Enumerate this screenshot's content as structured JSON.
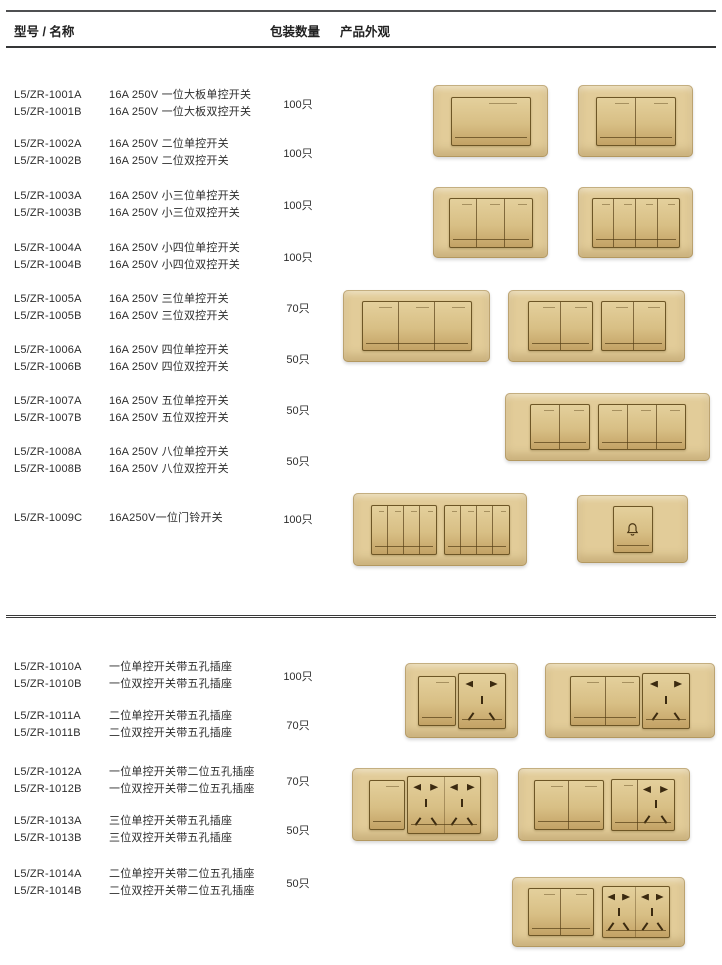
{
  "header": {
    "model_name": "型号 / 名称",
    "package_qty": "包装数量",
    "appearance": "产品外观"
  },
  "sections": [
    {
      "rows": [
        {
          "code_a": "L5/ZR-1001A",
          "desc_a": "16A 250V 一位大板单控开关",
          "code_b": "L5/ZR-1001B",
          "desc_b": "16A 250V 一位大板双控开关",
          "qty": "100只"
        },
        {
          "code_a": "L5/ZR-1002A",
          "desc_a": "16A 250V 二位单控开关",
          "code_b": "L5/ZR-1002B",
          "desc_b": "16A 250V 二位双控开关",
          "qty": "100只"
        },
        {
          "code_a": "L5/ZR-1003A",
          "desc_a": "16A 250V 小三位单控开关",
          "code_b": "L5/ZR-1003B",
          "desc_b": "16A 250V 小三位双控开关",
          "qty": "100只"
        },
        {
          "code_a": "L5/ZR-1004A",
          "desc_a": "16A 250V 小四位单控开关",
          "code_b": "L5/ZR-1004B",
          "desc_b": "16A 250V 小四位双控开关",
          "qty": "100只"
        },
        {
          "code_a": "L5/ZR-1005A",
          "desc_a": "16A 250V 三位单控开关",
          "code_b": "L5/ZR-1005B",
          "desc_b": "16A 250V 三位双控开关",
          "qty": "70只"
        },
        {
          "code_a": "L5/ZR-1006A",
          "desc_a": "16A 250V 四位单控开关",
          "code_b": "L5/ZR-1006B",
          "desc_b": "16A 250V 四位双控开关",
          "qty": "50只"
        },
        {
          "code_a": "L5/ZR-1007A",
          "desc_a": "16A 250V 五位单控开关",
          "code_b": "L5/ZR-1007B",
          "desc_b": "16A 250V 五位双控开关",
          "qty": "50只"
        },
        {
          "code_a": "L5/ZR-1008A",
          "desc_a": "16A 250V 八位单控开关",
          "code_b": "L5/ZR-1008B",
          "desc_b": "16A 250V 八位双控开关",
          "qty": "50只"
        },
        {
          "code_a": "L5/ZR-1009C",
          "desc_a": "16A250V一位门铃开关",
          "qty": "100只"
        }
      ]
    },
    {
      "rows": [
        {
          "code_a": "L5/ZR-1010A",
          "desc_a": "一位单控开关带五孔插座",
          "code_b": "L5/ZR-1010B",
          "desc_b": "一位双控开关带五孔插座",
          "qty": "100只"
        },
        {
          "code_a": "L5/ZR-1011A",
          "desc_a": "二位单控开关带五孔插座",
          "code_b": "L5/ZR-1011B",
          "desc_b": "二位双控开关带五孔插座",
          "qty": "70只"
        },
        {
          "code_a": "L5/ZR-1012A",
          "desc_a": "一位单控开关带二位五孔插座",
          "code_b": "L5/ZR-1012B",
          "desc_b": "一位双控开关带二位五孔插座",
          "qty": "70只"
        },
        {
          "code_a": "L5/ZR-1013A",
          "desc_a": "三位单控开关带五孔插座",
          "code_b": "L5/ZR-1013B",
          "desc_b": "三位双控开关带五孔插座",
          "qty": "50只"
        },
        {
          "code_a": "L5/ZR-1014A",
          "desc_a": "二位单控开关带二位五孔插座",
          "code_b": "L5/ZR-1014B",
          "desc_b": "二位双控开关带二位五孔插座",
          "qty": "50只"
        }
      ]
    }
  ],
  "appearance_gallery": [
    "one-gang-large-rocker-switch-plate",
    "two-gang-rocker-switch-plate",
    "small-three-gang-switch-plate",
    "small-four-gang-switch-plate",
    "three-gang-wide-switch-plate",
    "four-gang-wide-switch-plate",
    "five-gang-wide-switch-plate",
    "eight-gang-wide-switch-plate",
    "doorbell-switch-plate",
    "one-switch-five-hole-socket-plate",
    "two-switch-five-hole-socket-plate",
    "one-switch-double-five-hole-socket-plate",
    "three-switch-five-hole-socket-plate",
    "two-switch-double-five-hole-socket-plate"
  ],
  "colors": {
    "background": "#ffffff",
    "text": "#2d2d2d",
    "rule": "#3a3a3a",
    "plate_gold_light": "#ead9ac",
    "plate_gold": "#e2cc99",
    "plate_gold_dark": "#d2b47c",
    "module_outline": "#6d5626",
    "module_gold_top": "#e4d09c",
    "module_gold_bottom": "#c3a265",
    "socket_hole": "#3b2a10"
  }
}
